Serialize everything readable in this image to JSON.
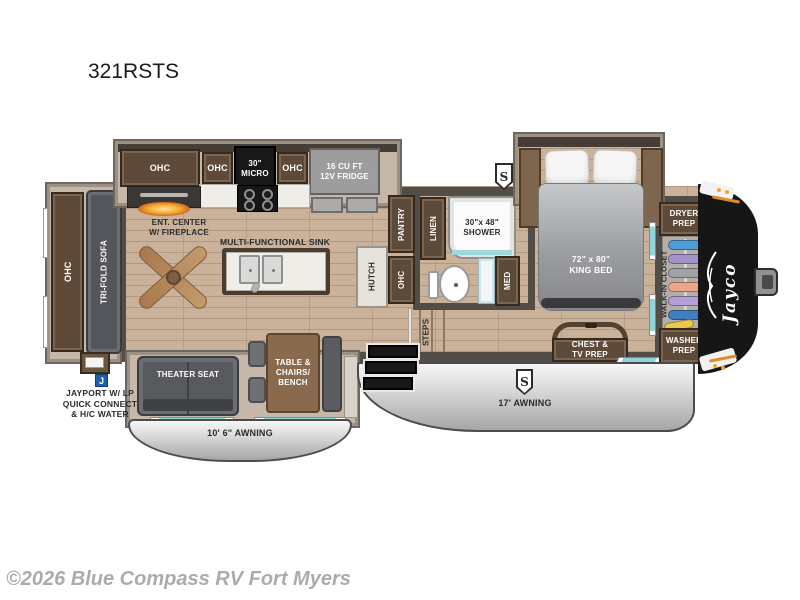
{
  "page": {
    "title": "321RSTS",
    "watermark": "©2026 Blue Compass RV Fort Myers"
  },
  "labels": {
    "rear_ohc": "OHC",
    "tri_fold_sofa": "TRI-FOLD SOFA",
    "kitchen_ohc_1": "OHC",
    "kitchen_ohc_2": "OHC",
    "micro": "30\"\nMICRO",
    "kitchen_ohc_3": "OHC",
    "fridge": "16 CU FT\n12V FRIDGE",
    "ent_center": "ENT. CENTER\nW/ FIREPLACE",
    "sink": "MULTI-FUNCTIONAL SINK",
    "hutch": "HUTCH",
    "pantry": "PANTRY",
    "hutch_ohc": "OHC",
    "linen": "LINEN",
    "shower": "30\"x 48\"\nSHOWER",
    "med": "MED",
    "steps": "STEPS",
    "king_bed": "72\" x 80\"\nKING BED",
    "dryer_prep": "DRYER\nPREP",
    "walk_in_closet": "WALK-IN CLOSET",
    "washer_prep": "WASHER\nPREP",
    "jayco_logo": "Jayco",
    "theater_seat": "THEATER SEAT",
    "dinette": "TABLE &\nCHAIRS/\nBENCH",
    "chest_tv": "CHEST &\nTV PREP",
    "awning_rear": "10' 6\" AWNING",
    "awning_main": "17' AWNING",
    "jayport": "JAYPORT W/ LP\nQUICK CONNECT\n& H/C WATER",
    "speaker_badge": "S",
    "jayport_badge": "J"
  },
  "colors": {
    "wall": "#524d47",
    "floor": "#c9b299",
    "cabinet": "#5d4a38",
    "front_cap": "#161616",
    "awning": "#d9d9d9",
    "window_teal": "#8fd4da",
    "badge_blue": "#1e5fa8",
    "accent_orange": "#f5a623"
  }
}
